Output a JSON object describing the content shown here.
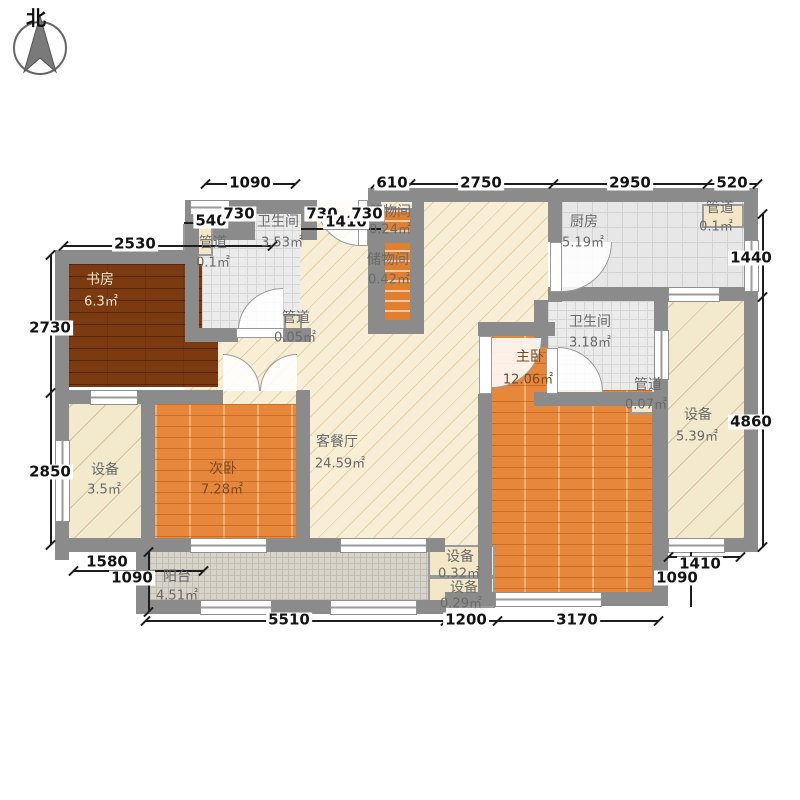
{
  "compass": {
    "north": "北"
  },
  "rooms": {
    "study": {
      "name": "书房",
      "area": "6.3㎡"
    },
    "bath_top": {
      "name": "卫生间",
      "area": "3.53㎡"
    },
    "duct_top_left": {
      "name": "管道",
      "area": "0.1㎡"
    },
    "duct_hall": {
      "name": "管道",
      "area": "0.05㎡"
    },
    "storage_upper": {
      "name": "储物间",
      "area": "0.24㎡"
    },
    "storage_lower": {
      "name": "储物间",
      "area": "0.42㎡"
    },
    "kitchen": {
      "name": "厨房",
      "area": "5.19㎡"
    },
    "duct_top_right": {
      "name": "管道",
      "area": "0.1㎡"
    },
    "living": {
      "name": "客餐厅",
      "area": "24.59㎡"
    },
    "bath_right": {
      "name": "卫生间",
      "area": "3.18㎡"
    },
    "duct_right": {
      "name": "管道",
      "area": "0.07㎡"
    },
    "master": {
      "name": "主卧",
      "area": "12.06㎡"
    },
    "equip_right": {
      "name": "设备",
      "area": "5.39㎡"
    },
    "equip_left": {
      "name": "设备",
      "area": "3.5㎡"
    },
    "bed2": {
      "name": "次卧",
      "area": "7.28㎡"
    },
    "balcony": {
      "name": "阳台",
      "area": "4.51㎡"
    },
    "equip_bottom1": {
      "name": "设备",
      "area": "0.32㎡"
    },
    "equip_bottom2": {
      "name": "设备",
      "area": "0.29㎡"
    }
  },
  "dims": {
    "top_1090": "1090",
    "top_610": "610",
    "top_2750": "2750",
    "top_2950": "2950",
    "top_520": "520",
    "in_540": "540",
    "in_730a": "730",
    "in_730b": "730",
    "in_1410": "1410",
    "in_730c": "730",
    "left_2530": "2530",
    "left_2730": "2730",
    "left_2850": "2850",
    "left_1580": "1580",
    "left_1090": "1090",
    "right_1440": "1440",
    "right_4860": "4860",
    "right_1410": "1410",
    "right_1090": "1090",
    "bottom_5510": "5510",
    "bottom_1200": "1200",
    "bottom_3170": "3170"
  }
}
